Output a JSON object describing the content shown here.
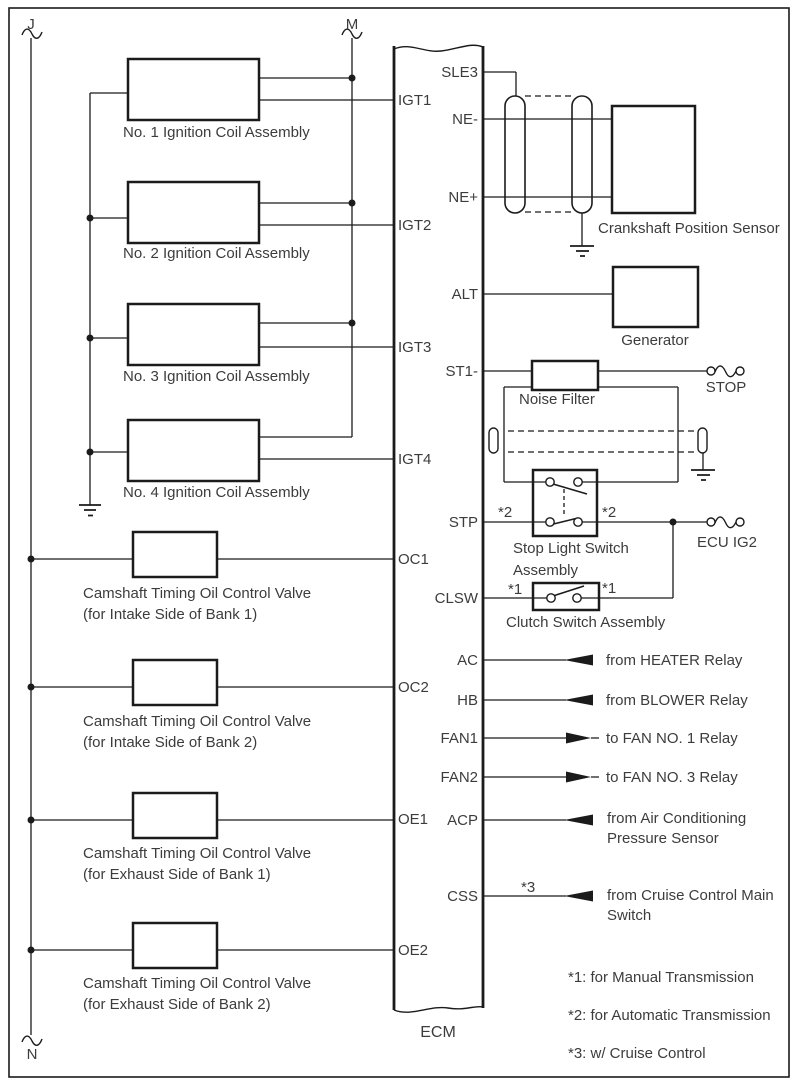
{
  "bus": {
    "j": "J",
    "m": "M",
    "n": "N"
  },
  "ecm": {
    "label": "ECM",
    "left_pins": [
      "IGT1",
      "IGT2",
      "IGT3",
      "IGT4",
      "OC1",
      "OC2",
      "OE1",
      "OE2"
    ],
    "right_pins": [
      "SLE3",
      "NE-",
      "NE+",
      "ALT",
      "ST1-",
      "STP",
      "CLSW",
      "AC",
      "HB",
      "FAN1",
      "FAN2",
      "ACP",
      "CSS"
    ]
  },
  "components": {
    "coil1": "No. 1 Ignition Coil Assembly",
    "coil2": "No. 2 Ignition Coil Assembly",
    "coil3": "No. 3 Ignition Coil Assembly",
    "coil4": "No. 4 Ignition Coil Assembly",
    "valve_line1": "Camshaft Timing Oil Control Valve",
    "valve1_line2": "(for Intake Side of Bank 1)",
    "valve2_line2": "(for Intake Side of Bank 2)",
    "valve3_line2": "(for Exhaust Side of Bank 1)",
    "valve4_line2": "(for Exhaust Side of Bank 2)",
    "crank_sensor": "Crankshaft Position Sensor",
    "generator": "Generator",
    "noise_filter": "Noise Filter",
    "stop": "STOP",
    "ecu_ig2": "ECU IG2",
    "stop_light_switch_line1": "Stop Light Switch",
    "stop_light_switch_line2": "Assembly",
    "clutch_switch": "Clutch Switch Assembly"
  },
  "flags": {
    "star1": "*1",
    "star2": "*2",
    "star3": "*3"
  },
  "arrows": {
    "ac": "from HEATER Relay",
    "hb": "from BLOWER Relay",
    "fan1": "to FAN NO. 1 Relay",
    "fan2": "to FAN NO. 3 Relay",
    "acp_line1": "from Air Conditioning",
    "acp_line2": "Pressure Sensor",
    "css_line1": "from Cruise Control Main",
    "css_line2": "Switch"
  },
  "notes": {
    "n1": "*1: for Manual Transmission",
    "n2": "*2: for Automatic Transmission",
    "n3": "*3: w/ Cruise Control"
  }
}
